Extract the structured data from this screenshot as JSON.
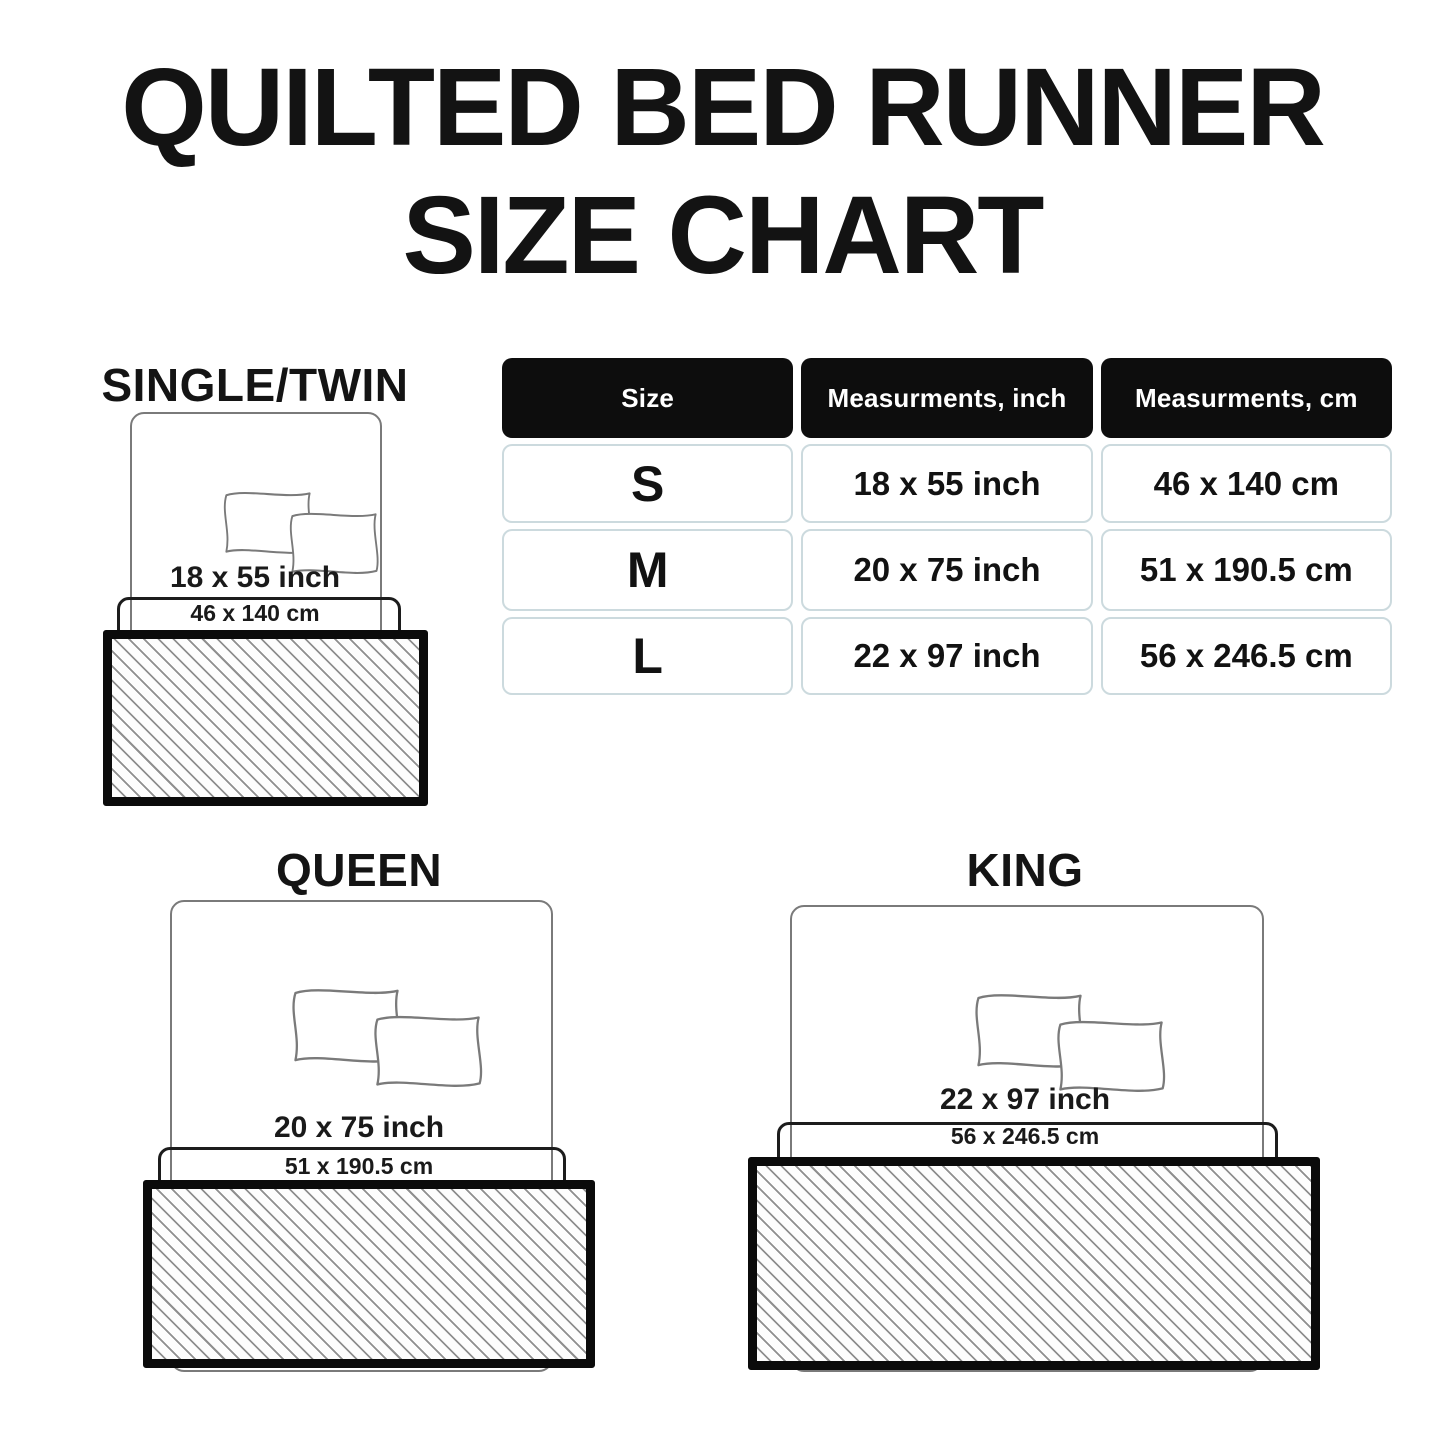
{
  "title": {
    "line1": "QUILTED BED RUNNER",
    "line2": "SIZE CHART"
  },
  "table": {
    "headers": [
      "Size",
      "Measurments, inch",
      "Measurments, cm"
    ],
    "rows": [
      {
        "size": "S",
        "inch": "18 x 55 inch",
        "cm": "46 x 140 cm"
      },
      {
        "size": "M",
        "inch": "20 x 75 inch",
        "cm": "51 x 190.5 cm"
      },
      {
        "size": "L",
        "inch": "22 x 97 inch",
        "cm": "56 x 246.5 cm"
      }
    ]
  },
  "diagrams": [
    {
      "label": "SINGLE/TWIN",
      "inch_label": "18 x 55 inch",
      "cm_label": "46 x 140 cm"
    },
    {
      "label": "QUEEN",
      "inch_label": "20 x 75 inch",
      "cm_label": "51 x 190.5 cm"
    },
    {
      "label": "KING",
      "inch_label": "22 x 97 inch",
      "cm_label": "56 x 246.5 cm"
    }
  ],
  "colors": {
    "text": "#131313",
    "table_header_bg": "#0d0d0d",
    "table_header_text": "#ffffff",
    "table_cell_border": "#ccdade",
    "bed_outline": "#7a7a7a",
    "runner_zone_outline": "#1c1c1c",
    "runner_border": "#0b0b0b",
    "hatch_line": "#8f8f8f"
  }
}
